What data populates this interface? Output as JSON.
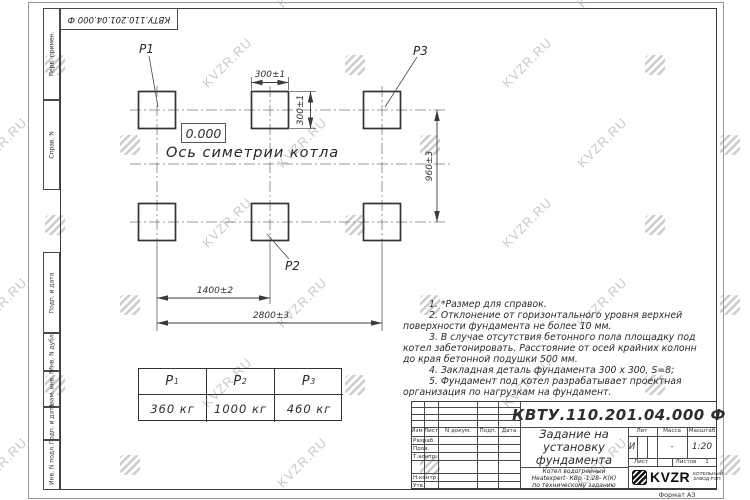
{
  "watermark": {
    "text": "KVZR.RU"
  },
  "top_stamp": {
    "doc_number": "КВТУ.110.201.04.000  Ф"
  },
  "margin_labels": [
    "Перв. примен.",
    "Справ. N",
    "Подп. и дата",
    "Инв. N дубл.",
    "Взам. инв. N",
    "Подп. и дата",
    "Инв. N подл."
  ],
  "plan": {
    "pad_labels": {
      "p1": "P1",
      "p2": "P2",
      "p3": "P3"
    },
    "level_mark": "0.000",
    "axis_label": "Ось симетрии котла",
    "dims": {
      "pad_width": "300±1",
      "pad_height": "300±1",
      "row_spacing": "960±3",
      "col_spacing": "1400±2",
      "total_span": "2800±3"
    }
  },
  "notes": [
    "1. *Размер для справок.",
    "2. Отклонение от горизонтального уровня верхней поверхности фундамента не более 10 мм.",
    "3. В случае отсутствия бетонного пола площадку под котел забетонировать. Расстояние от осей крайних колонн до края бетонной подушки 500 мм.",
    "4. Закладная деталь фундамента  300 x 300, S=8;",
    "5. Фундамент под котел разрабатывает проектная организация по нагрузкам на фундамент."
  ],
  "loads_table": {
    "headers": [
      {
        "base": "P",
        "sub": "1"
      },
      {
        "base": "P",
        "sub": "2"
      },
      {
        "base": "P",
        "sub": "3"
      }
    ],
    "values": [
      "360 кг",
      "1000 кг",
      "460 кг"
    ]
  },
  "title_block": {
    "doc_number": "КВТУ.110.201.04.000  Ф",
    "doc_title": "Задание на установку фундамента",
    "subtitle_lines": [
      "Котел водогрейный",
      "Heatexpert- КВр -1,28- К(К)",
      "по техническому заданию"
    ],
    "col_headers": {
      "izm": "Изм",
      "list": "Лист",
      "n_dokum": "N докум.",
      "podp": "Подп.",
      "data": "Дата"
    },
    "row_labels": [
      "Разраб.",
      "Пров.",
      "Т.контр.",
      "Н.контр.",
      "Утв."
    ],
    "lit": {
      "label": "Лит",
      "value": "И"
    },
    "massa": {
      "label": "Масса",
      "value": "-"
    },
    "masshtab": {
      "label": "Масштаб",
      "value": "1:20"
    },
    "sheet": {
      "list_label": "Лист",
      "listov_label": "Листов",
      "listov_value": "1"
    },
    "logo": {
      "text": "KVZR",
      "caption_lines": [
        "КОТЕЛЬНЫЙ",
        "ЗАВОД РЭП"
      ]
    },
    "format_label": "Формат А3"
  }
}
